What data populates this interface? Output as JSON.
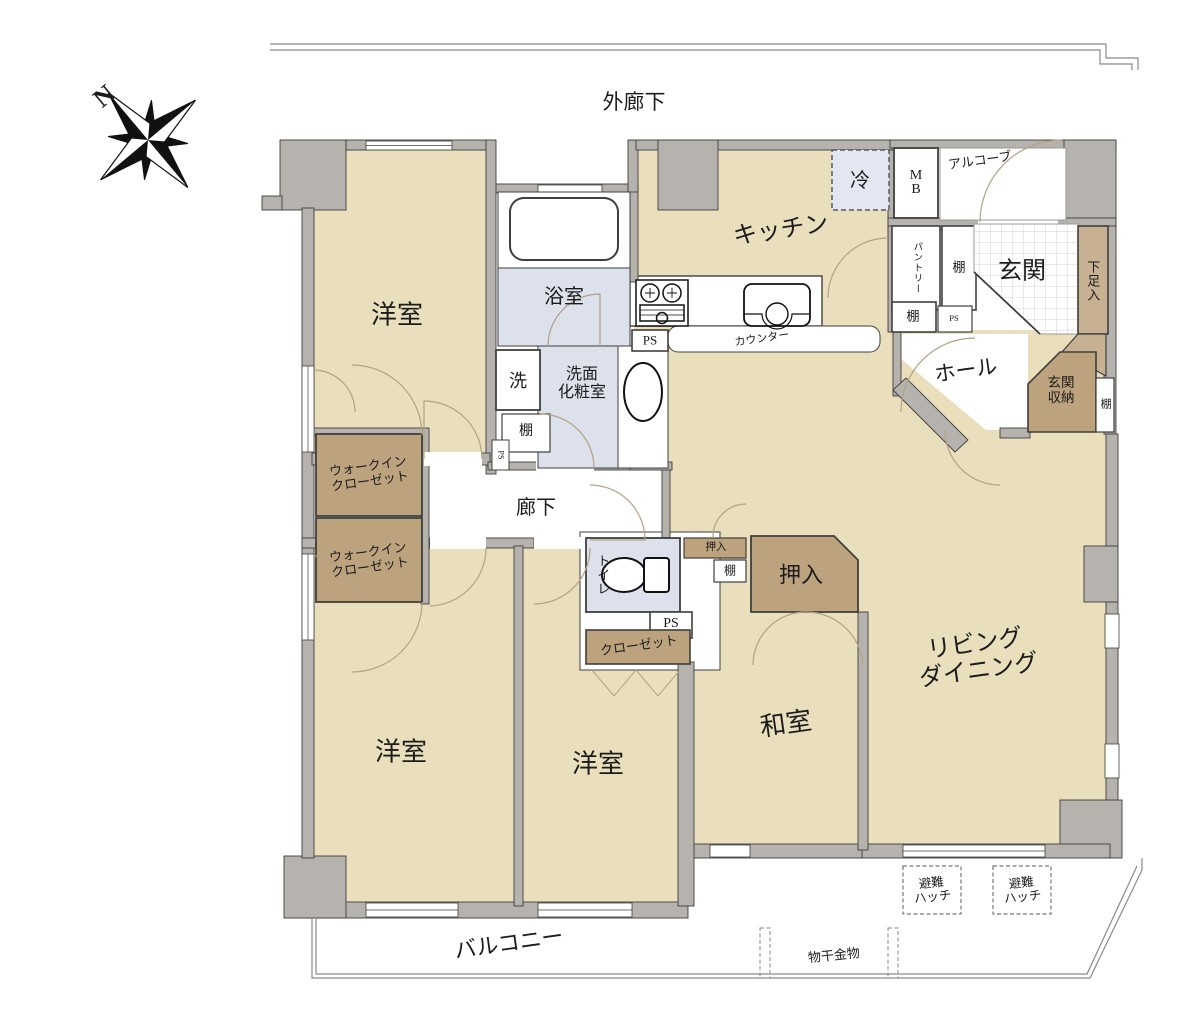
{
  "compass": {
    "north": "N"
  },
  "exterior": {
    "outer_corridor": "外廊下",
    "balcony": "バルコニー",
    "laundry_hardware": "物干金物",
    "escape_hatch_line1": "避難",
    "escape_hatch_line2": "ハッチ",
    "alcove": "アルコーブ"
  },
  "rooms": {
    "bedroom": "洋室",
    "japanese_room": "和室",
    "living_line1": "リビング",
    "living_line2": "ダイニング",
    "kitchen": "キッチン",
    "bathroom": "浴室",
    "powder_line1": "洗面",
    "powder_line2": "化粧室",
    "corridor": "廊下",
    "hall": "ホール",
    "entrance": "玄関",
    "toilet": "トイレ"
  },
  "fixtures": {
    "refrigerator": "冷",
    "meter_box_line1": "M",
    "meter_box_line2": "B",
    "pantry": "パントリー",
    "shelf": "棚",
    "shoe_cabinet": "下足入",
    "pipe_space": "PS",
    "counter": "カウンター",
    "washer": "洗",
    "entrance_storage_line1": "玄関",
    "entrance_storage_line2": "収納",
    "wic_line1": "ウォークイン",
    "wic_line2": "クローゼット",
    "closet": "クローゼット",
    "oshiire": "押入"
  },
  "colors": {
    "room_beige": "#e9dfbc",
    "wall_gray": "#b6b3ae",
    "wall_outline": "#3f3f3d",
    "wet_area_blue": "#dde1ec",
    "storage_brown": "#bca37e",
    "storage_light_brown": "#c8b193",
    "door_arc_tan": "#b3a284"
  }
}
